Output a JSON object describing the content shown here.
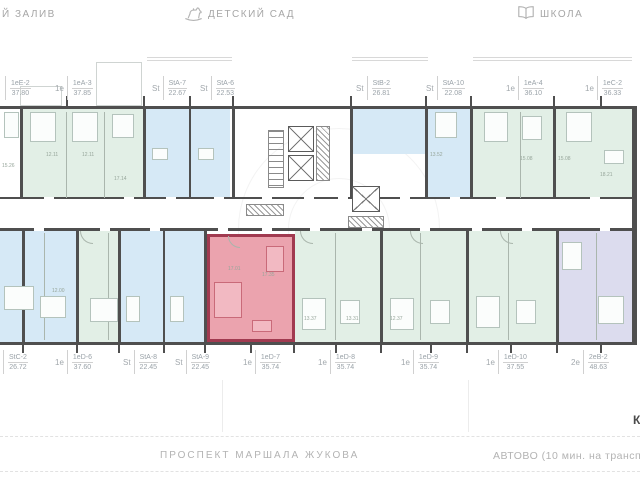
{
  "header": {
    "bay": "Й ЗАЛИВ",
    "kindergarten": "ДЕТСКИЙ САД",
    "school": "ШКОЛА"
  },
  "footer": {
    "street": "ПРОСПЕКТ МАРШАЛА ЖУКОВА",
    "metro": "АВТОВО (10 мин. на трансп",
    "right_edge_text": "К"
  },
  "selected_unit": {
    "code": "1еD-7",
    "area": "35.74",
    "type": "1е"
  },
  "units_top": [
    {
      "prefix": "",
      "code": "1еЕ-2",
      "area": "37.80",
      "x": 5
    },
    {
      "prefix": "1е",
      "code": "1еА-3",
      "area": "37.85",
      "x": 55
    },
    {
      "prefix": "St",
      "code": "StA-7",
      "area": "22.67",
      "x": 152
    },
    {
      "prefix": "St",
      "code": "StA-6",
      "area": "22.53",
      "x": 200
    },
    {
      "prefix": "St",
      "code": "StB-2",
      "area": "26.81",
      "x": 356
    },
    {
      "prefix": "St",
      "code": "StA-10",
      "area": "22.08",
      "x": 426
    },
    {
      "prefix": "1е",
      "code": "1еА-4",
      "area": "36.10",
      "x": 506
    },
    {
      "prefix": "1е",
      "code": "1еС-2",
      "area": "36.33",
      "x": 585
    }
  ],
  "units_bottom": [
    {
      "prefix": "",
      "code": "StC-2",
      "area": "26.72",
      "x": 3
    },
    {
      "prefix": "1е",
      "code": "1еD-6",
      "area": "37.60",
      "x": 55
    },
    {
      "prefix": "St",
      "code": "StA-8",
      "area": "22.45",
      "x": 123
    },
    {
      "prefix": "St",
      "code": "StA-9",
      "area": "22.45",
      "x": 175
    },
    {
      "prefix": "1е",
      "code": "1еD-7",
      "area": "35.74",
      "x": 243,
      "selected": true
    },
    {
      "prefix": "1е",
      "code": "1еD-8",
      "area": "35.74",
      "x": 318
    },
    {
      "prefix": "1е",
      "code": "1еD-9",
      "area": "35.74",
      "x": 401
    },
    {
      "prefix": "1е",
      "code": "1еD-10",
      "area": "37.55",
      "x": 486
    },
    {
      "prefix": "2е",
      "code": "2еВ-2",
      "area": "48.63",
      "x": 571
    }
  ],
  "room_areas": [
    {
      "t": "15.26",
      "x": 2,
      "y": 163
    },
    {
      "t": "12.11",
      "x": 46,
      "y": 152
    },
    {
      "t": "12.11",
      "x": 82,
      "y": 152
    },
    {
      "t": "17.14",
      "x": 114,
      "y": 176
    },
    {
      "t": "13.52",
      "x": 430,
      "y": 152
    },
    {
      "t": "15.08",
      "x": 520,
      "y": 156
    },
    {
      "t": "15.08",
      "x": 558,
      "y": 156
    },
    {
      "t": "18.21",
      "x": 600,
      "y": 172
    },
    {
      "t": "12.00",
      "x": 52,
      "y": 288
    },
    {
      "t": "17.01",
      "x": 228,
      "y": 266
    },
    {
      "t": "17.35",
      "x": 262,
      "y": 272
    },
    {
      "t": "13.37",
      "x": 304,
      "y": 316
    },
    {
      "t": "13.31",
      "x": 346,
      "y": 316
    },
    {
      "t": "12.37",
      "x": 390,
      "y": 316
    }
  ],
  "colors": {
    "wall": "#4f4f4f",
    "green": "#e2efe6",
    "blue": "#d6e9f6",
    "lavender": "#dcdcee",
    "selected_fill": "#eba3ae",
    "selected_wall": "#a13a50",
    "label_text": "#9aa2a8",
    "street_text": "#b3b3b3"
  }
}
